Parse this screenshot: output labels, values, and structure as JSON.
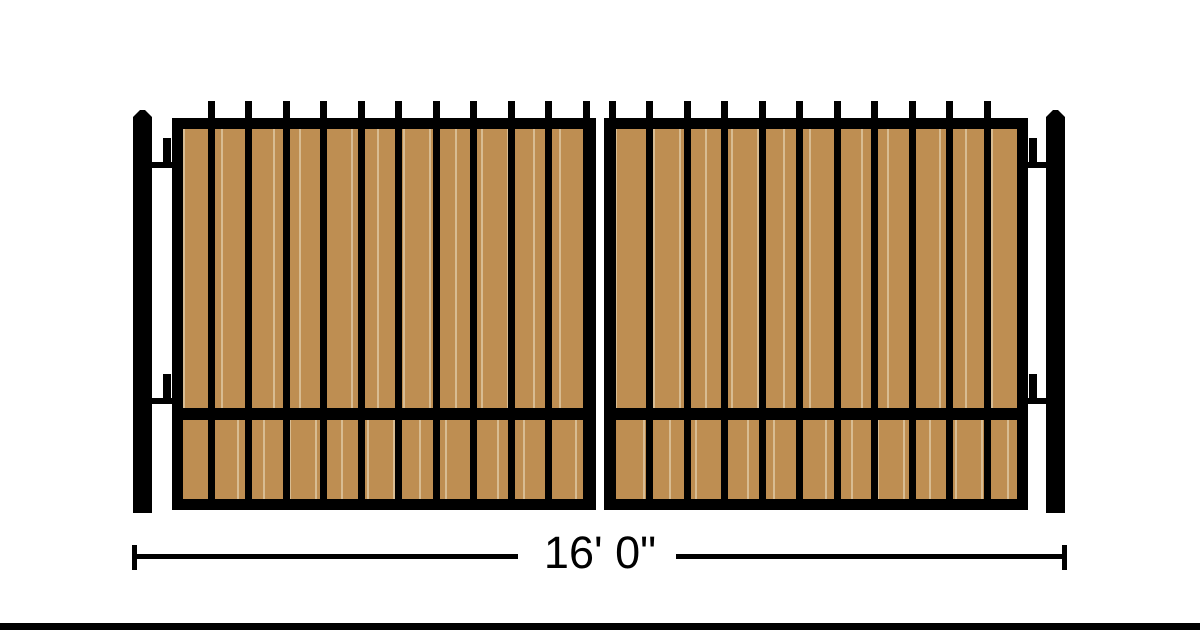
{
  "diagram": {
    "name": "double-swing-gate-elevation",
    "dimension_label": "16' 0\"",
    "leaf_count": 2,
    "pickets_per_leaf": 11,
    "posts": 2,
    "hinges_per_side": 2
  },
  "colors": {
    "frame": "#000000",
    "wood": "#be8e52",
    "wood_seam": "#d8bc92",
    "background": "#ffffff",
    "dimension_text": "#000000"
  }
}
